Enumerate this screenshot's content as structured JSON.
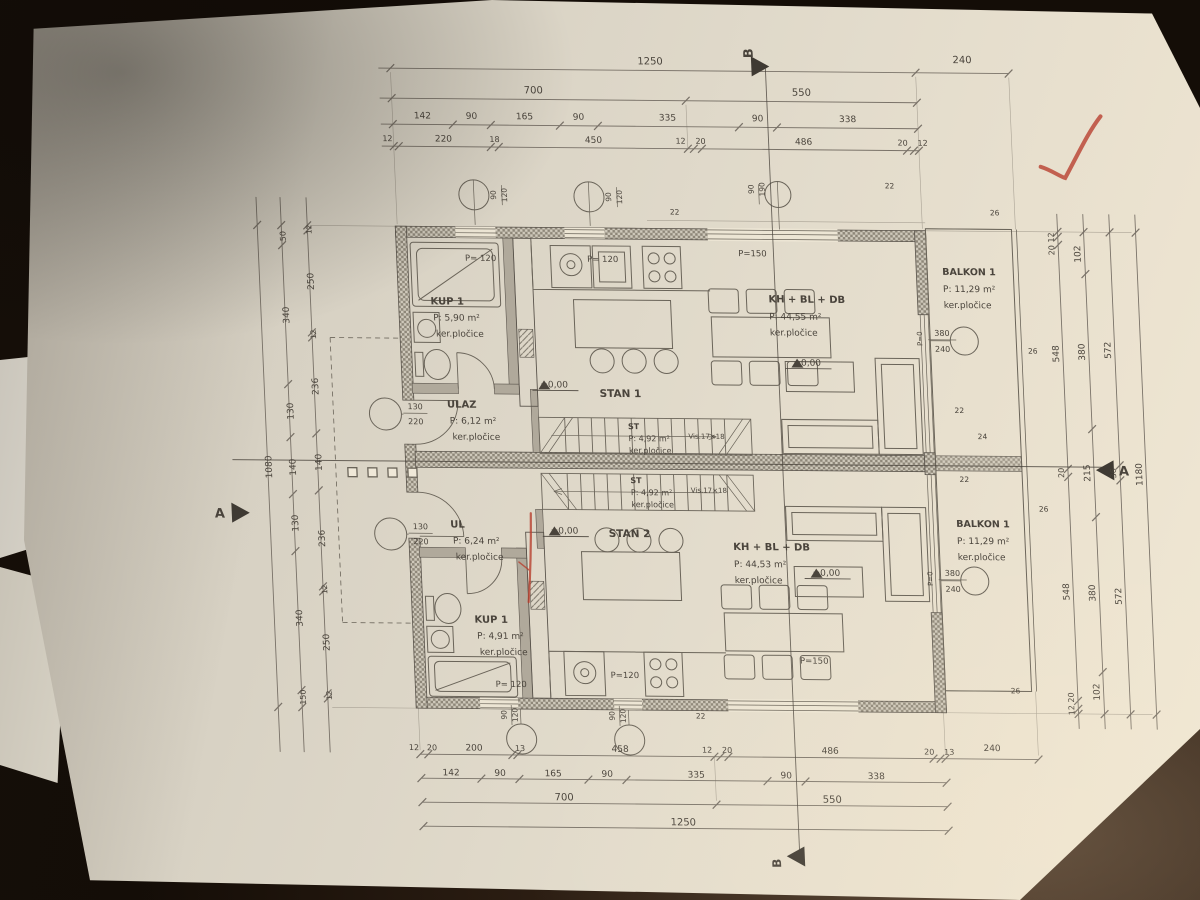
{
  "scene": {
    "type": "photo of architectural floor plan sheet on dark table",
    "red_pen_marks": [
      "checkmark top right",
      "vertical red line near STAN 2 entry"
    ],
    "handwriting": "171"
  },
  "plan": {
    "units": [
      "STAN 1",
      "STAN 2"
    ],
    "rooms": [
      {
        "unit": "STAN 1",
        "label": "KUP 1",
        "area": "P: 5,90 m²",
        "finish": "ker.pločice"
      },
      {
        "unit": "STAN 1",
        "label": "ULAZ",
        "area": "P: 6,12 m²",
        "finish": "ker.pločice"
      },
      {
        "unit": "STAN 1",
        "label": "KH + BL + DB",
        "area": "P: 44,55 m²",
        "finish": "ker.pločice"
      },
      {
        "unit": "STAN 1",
        "label": "ST",
        "area": "P: 4,92 m²",
        "finish": "ker.pločice"
      },
      {
        "unit": "STAN 1",
        "label": "BALKON 1",
        "area": "P: 11,29 m²",
        "finish": "ker.pločice"
      },
      {
        "unit": "STAN 2",
        "label": "UL",
        "area": "P: 6,24 m²",
        "finish": "ker.pločice"
      },
      {
        "unit": "STAN 2",
        "label": "KUP 1",
        "area": "P: 4,91 m²",
        "finish": "ker.pločice"
      },
      {
        "unit": "STAN 2",
        "label": "KH + BL + DB",
        "area": "P: 44,53 m²",
        "finish": "ker.pločice"
      },
      {
        "unit": "STAN 2",
        "label": "ST",
        "area": "P: 4,92 m²",
        "finish": "ker.pločice"
      },
      {
        "unit": "STAN 2",
        "label": "BALKON 1",
        "area": "P: 11,29 m²",
        "finish": "ker.pločice"
      }
    ],
    "levels": "±0,00",
    "sections": [
      "A",
      "B"
    ],
    "dimensions": {
      "top": [
        [
          "1250",
          "240"
        ],
        [
          "700",
          "550"
        ],
        [
          "142",
          "90",
          "165",
          "90",
          "335",
          "90",
          "338"
        ],
        [
          "12",
          "220",
          "18",
          "450",
          "12",
          "20",
          "486",
          "20",
          "12"
        ]
      ],
      "bottom": [
        [
          "12",
          "20",
          "200",
          "13",
          "458",
          "12",
          "20",
          "486",
          "20",
          "13",
          "240"
        ],
        [
          "142",
          "90",
          "165",
          "90",
          "335",
          "90",
          "338"
        ],
        [
          "700",
          "550"
        ],
        [
          "1250"
        ]
      ],
      "right": [
        [
          "20 12",
          "548",
          "20",
          "548",
          "12 20"
        ],
        [
          "102",
          "380",
          "215",
          "380",
          "102"
        ],
        [
          "572",
          "36",
          "572"
        ],
        [
          "1180"
        ]
      ],
      "left": [
        [
          "12",
          "250",
          "12",
          "236",
          "140",
          "236",
          "12",
          "250",
          "12"
        ],
        [
          "50",
          "340",
          "130",
          "140",
          "130",
          "340",
          "150"
        ],
        [
          "1080"
        ]
      ]
    },
    "opening_markers": [
      "90/120",
      "90/190",
      "130/220",
      "380/240",
      "P= 120",
      "P=120",
      "P=150",
      "P=0"
    ]
  },
  "annotations": [
    {
      "t": "1250",
      "x": 650,
      "y": 64,
      "s": 10
    },
    {
      "t": "240",
      "x": 962,
      "y": 60,
      "s": 10
    },
    {
      "t": "700",
      "x": 532,
      "y": 94,
      "s": 10
    },
    {
      "t": "550",
      "x": 800,
      "y": 94,
      "s": 10
    },
    {
      "t": "142",
      "x": 420,
      "y": 120,
      "s": 9
    },
    {
      "t": "90",
      "x": 469,
      "y": 120,
      "s": 9
    },
    {
      "t": "165",
      "x": 522,
      "y": 120,
      "s": 9
    },
    {
      "t": "90",
      "x": 576,
      "y": 120,
      "s": 9
    },
    {
      "t": "335",
      "x": 665,
      "y": 120,
      "s": 9
    },
    {
      "t": "90",
      "x": 755,
      "y": 120,
      "s": 9
    },
    {
      "t": "338",
      "x": 845,
      "y": 120,
      "s": 9
    },
    {
      "t": "12",
      "x": 384,
      "y": 143,
      "s": 8
    },
    {
      "t": "220",
      "x": 440,
      "y": 143,
      "s": 9
    },
    {
      "t": "18",
      "x": 491,
      "y": 143,
      "s": 8
    },
    {
      "t": "450",
      "x": 590,
      "y": 143,
      "s": 9
    },
    {
      "t": "12",
      "x": 677,
      "y": 143,
      "s": 8
    },
    {
      "t": "20",
      "x": 697,
      "y": 143,
      "s": 8
    },
    {
      "t": "486",
      "x": 800,
      "y": 143,
      "s": 9
    },
    {
      "t": "20",
      "x": 899,
      "y": 143,
      "s": 8
    },
    {
      "t": "12",
      "x": 919,
      "y": 143,
      "s": 8
    },
    {
      "t": "12",
      "x": 384,
      "y": 752,
      "s": 8
    },
    {
      "t": "20",
      "x": 402,
      "y": 752,
      "s": 8
    },
    {
      "t": "200",
      "x": 444,
      "y": 752,
      "s": 9
    },
    {
      "t": "13",
      "x": 490,
      "y": 752,
      "s": 8
    },
    {
      "t": "458",
      "x": 590,
      "y": 752,
      "s": 9
    },
    {
      "t": "12",
      "x": 677,
      "y": 752,
      "s": 8
    },
    {
      "t": "20",
      "x": 697,
      "y": 752,
      "s": 8
    },
    {
      "t": "486",
      "x": 800,
      "y": 752,
      "s": 9
    },
    {
      "t": "20",
      "x": 899,
      "y": 752,
      "s": 8
    },
    {
      "t": "13",
      "x": 919,
      "y": 752,
      "s": 8
    },
    {
      "t": "240",
      "x": 962,
      "y": 748,
      "s": 9
    },
    {
      "t": "142",
      "x": 420,
      "y": 777,
      "s": 9
    },
    {
      "t": "90",
      "x": 469,
      "y": 777,
      "s": 9
    },
    {
      "t": "165",
      "x": 522,
      "y": 777,
      "s": 9
    },
    {
      "t": "90",
      "x": 576,
      "y": 777,
      "s": 9
    },
    {
      "t": "335",
      "x": 665,
      "y": 777,
      "s": 9
    },
    {
      "t": "90",
      "x": 755,
      "y": 777,
      "s": 9
    },
    {
      "t": "338",
      "x": 845,
      "y": 777,
      "s": 9
    },
    {
      "t": "700",
      "x": 532,
      "y": 801,
      "s": 10
    },
    {
      "t": "550",
      "x": 800,
      "y": 801,
      "s": 10
    },
    {
      "t": "1250",
      "x": 650,
      "y": 825,
      "s": 10
    },
    {
      "t": "20 12",
      "x": 1046,
      "y": 240,
      "r": -90,
      "s": 8
    },
    {
      "t": "548",
      "x": 1046,
      "y": 350,
      "r": -90,
      "s": 9
    },
    {
      "t": "20",
      "x": 1046,
      "y": 469,
      "r": -90,
      "s": 8
    },
    {
      "t": "548",
      "x": 1046,
      "y": 588,
      "r": -90,
      "s": 9
    },
    {
      "t": "12 20",
      "x": 1046,
      "y": 700,
      "r": -90,
      "s": 8
    },
    {
      "t": "102",
      "x": 1072,
      "y": 250,
      "r": -90,
      "s": 9
    },
    {
      "t": "380",
      "x": 1072,
      "y": 348,
      "r": -90,
      "s": 9
    },
    {
      "t": "215",
      "x": 1072,
      "y": 469,
      "r": -90,
      "s": 9
    },
    {
      "t": "380",
      "x": 1072,
      "y": 589,
      "r": -90,
      "s": 9
    },
    {
      "t": "102",
      "x": 1072,
      "y": 688,
      "r": -90,
      "s": 9
    },
    {
      "t": "572",
      "x": 1098,
      "y": 346,
      "r": -90,
      "s": 9
    },
    {
      "t": "36",
      "x": 1098,
      "y": 469,
      "r": -90,
      "s": 8
    },
    {
      "t": "572",
      "x": 1098,
      "y": 592,
      "r": -90,
      "s": 9
    },
    {
      "t": "1180",
      "x": 1124,
      "y": 470,
      "r": -90,
      "s": 9
    },
    {
      "t": "12",
      "x": 304,
      "y": 232,
      "r": -90,
      "s": 7.5
    },
    {
      "t": "250",
      "x": 304,
      "y": 284,
      "r": -90,
      "s": 9
    },
    {
      "t": "12",
      "x": 304,
      "y": 337,
      "r": -90,
      "s": 7.5
    },
    {
      "t": "236",
      "x": 304,
      "y": 389,
      "r": -90,
      "s": 9
    },
    {
      "t": "140",
      "x": 304,
      "y": 465,
      "r": -90,
      "s": 9
    },
    {
      "t": "236",
      "x": 304,
      "y": 541,
      "r": -90,
      "s": 9
    },
    {
      "t": "12",
      "x": 304,
      "y": 592,
      "r": -90,
      "s": 7.5
    },
    {
      "t": "250",
      "x": 304,
      "y": 645,
      "r": -90,
      "s": 9
    },
    {
      "t": "12",
      "x": 304,
      "y": 698,
      "r": -90,
      "s": 7.5
    },
    {
      "t": "50",
      "x": 278,
      "y": 239,
      "r": -90,
      "s": 8
    },
    {
      "t": "340",
      "x": 278,
      "y": 318,
      "r": -90,
      "s": 9
    },
    {
      "t": "130",
      "x": 278,
      "y": 414,
      "r": -90,
      "s": 9
    },
    {
      "t": "140",
      "x": 278,
      "y": 470,
      "r": -90,
      "s": 9
    },
    {
      "t": "130",
      "x": 278,
      "y": 526,
      "r": -90,
      "s": 9
    },
    {
      "t": "340",
      "x": 278,
      "y": 621,
      "r": -90,
      "s": 9
    },
    {
      "t": "150",
      "x": 278,
      "y": 700,
      "r": -90,
      "s": 8
    },
    {
      "t": "1080",
      "x": 254,
      "y": 470,
      "r": -90,
      "s": 9
    },
    {
      "t": "P= 120",
      "x": 472,
      "y": 262,
      "s": 8.5
    },
    {
      "t": "P= 120",
      "x": 594,
      "y": 262,
      "s": 8.5
    },
    {
      "t": "P=150",
      "x": 744,
      "y": 255,
      "s": 8.5
    },
    {
      "t": "P= 120",
      "x": 484,
      "y": 688,
      "s": 8.5
    },
    {
      "t": "P=120",
      "x": 598,
      "y": 678,
      "s": 8.5
    },
    {
      "t": "P=150",
      "x": 788,
      "y": 662,
      "s": 8.5
    },
    {
      "t": "90",
      "x": 490,
      "y": 196,
      "r": -90,
      "s": 7.5
    },
    {
      "t": "120",
      "x": 501,
      "y": 196,
      "r": -90,
      "s": 7.5
    },
    {
      "t": "90",
      "x": 605,
      "y": 197,
      "r": -90,
      "s": 7.5
    },
    {
      "t": "120",
      "x": 616,
      "y": 197,
      "r": -90,
      "s": 7.5
    },
    {
      "t": "90",
      "x": 748,
      "y": 188,
      "r": -90,
      "s": 7.5
    },
    {
      "t": "190",
      "x": 759,
      "y": 188,
      "r": -90,
      "s": 7.5
    },
    {
      "t": "90",
      "x": 478,
      "y": 716,
      "r": -90,
      "s": 7.5
    },
    {
      "t": "120",
      "x": 489,
      "y": 716,
      "r": -90,
      "s": 7.5
    },
    {
      "t": "90",
      "x": 586,
      "y": 716,
      "r": -90,
      "s": 7.5
    },
    {
      "t": "120",
      "x": 597,
      "y": 716,
      "r": -90,
      "s": 7.5
    },
    {
      "t": "130",
      "x": 400,
      "y": 411,
      "s": 8
    },
    {
      "t": "220",
      "x": 400,
      "y": 426,
      "s": 8
    },
    {
      "t": "130",
      "x": 400,
      "y": 531,
      "s": 8
    },
    {
      "t": "220",
      "x": 400,
      "y": 546,
      "s": 8
    },
    {
      "t": "380",
      "x": 930,
      "y": 333,
      "s": 8
    },
    {
      "t": "240",
      "x": 930,
      "y": 349,
      "s": 8
    },
    {
      "t": "380",
      "x": 930,
      "y": 573,
      "s": 8
    },
    {
      "t": "240",
      "x": 930,
      "y": 589,
      "s": 8
    },
    {
      "t": "P=0",
      "x": 910,
      "y": 336,
      "r": -90,
      "s": 7
    },
    {
      "t": "P=0",
      "x": 910,
      "y": 576,
      "r": -90,
      "s": 7
    },
    {
      "t": "22",
      "x": 668,
      "y": 214,
      "s": 7.5
    },
    {
      "t": "22",
      "x": 884,
      "y": 186,
      "s": 7.5
    },
    {
      "t": "26",
      "x": 988,
      "y": 212,
      "s": 7.5
    },
    {
      "t": "26",
      "x": 1020,
      "y": 350,
      "s": 7.5
    },
    {
      "t": "22",
      "x": 944,
      "y": 410,
      "s": 7.5
    },
    {
      "t": "24",
      "x": 966,
      "y": 436,
      "s": 7.5
    },
    {
      "t": "22",
      "x": 946,
      "y": 479,
      "s": 7.5
    },
    {
      "t": "26",
      "x": 1024,
      "y": 508,
      "s": 7.5
    },
    {
      "t": "22",
      "x": 672,
      "y": 718,
      "s": 7.5
    },
    {
      "t": "26",
      "x": 988,
      "y": 690,
      "s": 7.5
    },
    {
      "t": "KUP 1",
      "x": 420,
      "y": 306,
      "s": 10,
      "w": "bold",
      "a": "start"
    },
    {
      "t": "P: 5,90 m²",
      "x": 422,
      "y": 322,
      "a": "start"
    },
    {
      "t": "ker.pločice",
      "x": 424,
      "y": 338,
      "a": "start"
    },
    {
      "t": "ULAZ",
      "x": 432,
      "y": 409,
      "s": 10,
      "w": "bold",
      "a": "start"
    },
    {
      "t": "P: 6,12 m²",
      "x": 434,
      "y": 425,
      "a": "start"
    },
    {
      "t": "ker.pločice",
      "x": 436,
      "y": 441,
      "a": "start"
    },
    {
      "t": "STAN 1",
      "x": 585,
      "y": 397,
      "s": 10.5,
      "w": "bold",
      "a": "start"
    },
    {
      "t": "KH + BL + DB",
      "x": 758,
      "y": 301,
      "s": 10,
      "w": "bold",
      "a": "start"
    },
    {
      "t": "P: 44,55 m²",
      "x": 758,
      "y": 318,
      "a": "start"
    },
    {
      "t": "ker.pločice",
      "x": 758,
      "y": 334,
      "a": "start"
    },
    {
      "t": "BALKON 1",
      "x": 933,
      "y": 272,
      "s": 9.5,
      "w": "bold",
      "a": "start"
    },
    {
      "t": "P: 11,29 m²",
      "x": 933,
      "y": 289,
      "a": "start"
    },
    {
      "t": "ker.pločice",
      "x": 933,
      "y": 305,
      "a": "start"
    },
    {
      "t": "ST",
      "x": 612,
      "y": 429,
      "s": 8,
      "w": "bold",
      "a": "start"
    },
    {
      "t": "P: 4,92 m²",
      "x": 612,
      "y": 441,
      "s": 8,
      "a": "start"
    },
    {
      "t": "ker.pločice",
      "x": 612,
      "y": 453,
      "s": 8,
      "a": "start"
    },
    {
      "t": "Vis.17×18",
      "x": 672,
      "y": 438,
      "s": 7,
      "a": "start"
    },
    {
      "t": "ST",
      "x": 612,
      "y": 483,
      "s": 8,
      "w": "bold",
      "a": "start"
    },
    {
      "t": "P: 4,92 m²",
      "x": 612,
      "y": 495,
      "s": 8,
      "a": "start"
    },
    {
      "t": "ker.pločice",
      "x": 612,
      "y": 507,
      "s": 8,
      "a": "start"
    },
    {
      "t": "Vis.17×18",
      "x": 672,
      "y": 492,
      "s": 7,
      "a": "start"
    },
    {
      "t": "UL",
      "x": 430,
      "y": 529,
      "s": 10,
      "w": "bold",
      "a": "start"
    },
    {
      "t": "P: 6,24 m²",
      "x": 432,
      "y": 545,
      "a": "start"
    },
    {
      "t": "ker.pločice",
      "x": 434,
      "y": 561,
      "a": "start"
    },
    {
      "t": "STAN 2",
      "x": 588,
      "y": 537,
      "s": 10.5,
      "w": "bold",
      "a": "start"
    },
    {
      "t": "KH + BL + DB",
      "x": 712,
      "y": 549,
      "s": 10,
      "w": "bold",
      "a": "start"
    },
    {
      "t": "P: 44,53 m²",
      "x": 712,
      "y": 566,
      "a": "start"
    },
    {
      "t": "ker.pločice",
      "x": 712,
      "y": 582,
      "a": "start"
    },
    {
      "t": "KUP 1",
      "x": 450,
      "y": 624,
      "s": 10,
      "w": "bold",
      "a": "start"
    },
    {
      "t": "P: 4,91 m²",
      "x": 452,
      "y": 640,
      "a": "start"
    },
    {
      "t": "ker.pločice",
      "x": 454,
      "y": 656,
      "a": "start"
    },
    {
      "t": "BALKON 1",
      "x": 936,
      "y": 524,
      "s": 9.5,
      "w": "bold",
      "a": "start"
    },
    {
      "t": "P: 11,29 m²",
      "x": 936,
      "y": 541,
      "a": "start"
    },
    {
      "t": "ker.pločice",
      "x": 936,
      "y": 557,
      "a": "start"
    },
    {
      "t": "±0,00",
      "x": 540,
      "y": 388,
      "s": 9
    },
    {
      "t": "±0,00",
      "x": 794,
      "y": 364,
      "s": 9
    },
    {
      "t": "±0,00",
      "x": 544,
      "y": 534,
      "s": 9
    },
    {
      "t": "±0,00",
      "x": 804,
      "y": 574,
      "s": 9
    },
    {
      "t": "B",
      "x": 753,
      "y": 52,
      "s": 13,
      "w": "bold",
      "r": -90
    },
    {
      "t": "B",
      "x": 746,
      "y": 862,
      "s": 12,
      "w": "bold",
      "r": -90
    },
    {
      "t": "A",
      "x": 200,
      "y": 521,
      "s": 13,
      "w": "bold"
    },
    {
      "t": "A",
      "x": 1106,
      "y": 471,
      "s": 13,
      "w": "bold"
    },
    {
      "t": "171",
      "x": 1058,
      "y": 884,
      "s": 30,
      "r": -8,
      "c": "pencil"
    }
  ]
}
